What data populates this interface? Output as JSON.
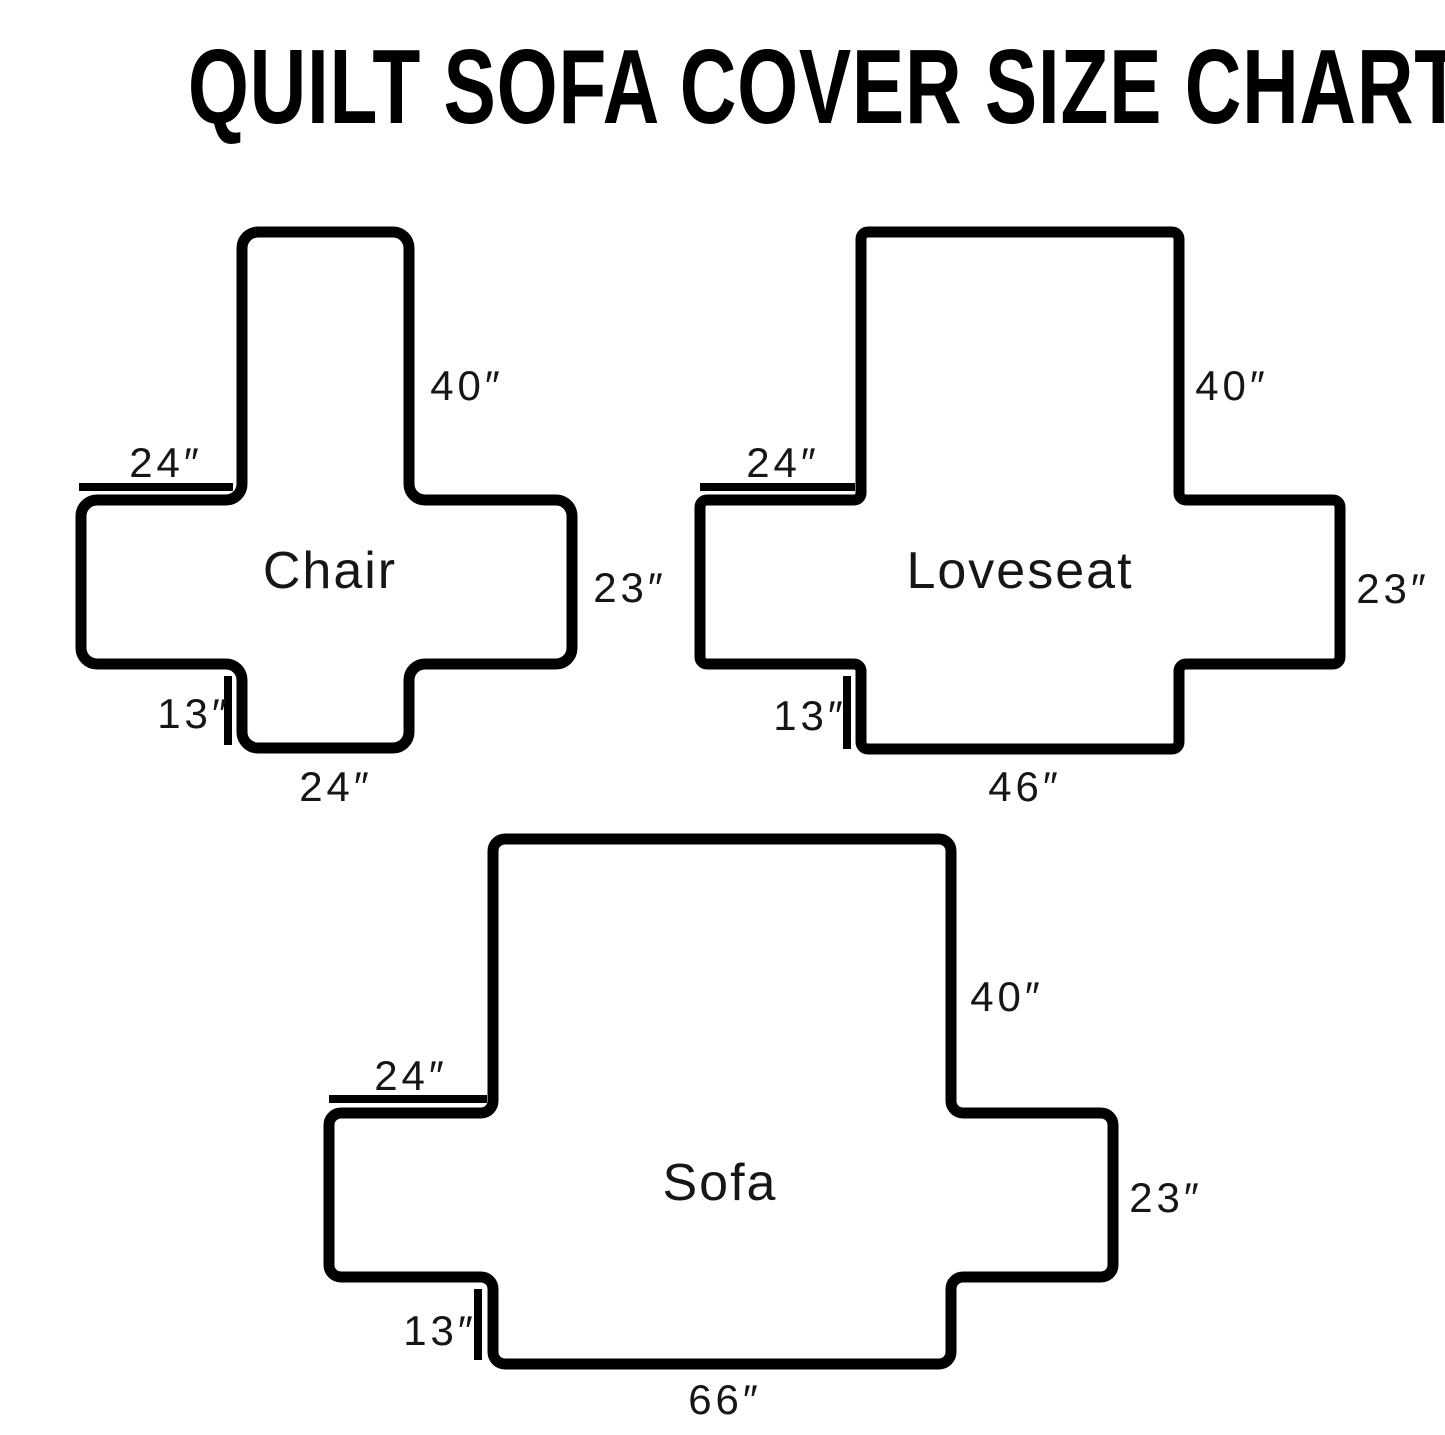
{
  "title": "QUILT SOFA COVER SIZE CHART",
  "colors": {
    "outline": "#000000",
    "text": "#161616",
    "background": "#ffffff"
  },
  "diagrams": [
    {
      "name": "Chair",
      "back_height": "40″",
      "arm_top_width": "24″",
      "arm_side_height": "23″",
      "flap_height": "13″",
      "bottom_width": "24″"
    },
    {
      "name": "Loveseat",
      "back_height": "40″",
      "arm_top_width": "24″",
      "arm_side_height": "23″",
      "flap_height": "13″",
      "bottom_width": "46″"
    },
    {
      "name": "Sofa",
      "back_height": "40″",
      "arm_top_width": "24″",
      "arm_side_height": "23″",
      "flap_height": "13″",
      "bottom_width": "66″"
    }
  ]
}
